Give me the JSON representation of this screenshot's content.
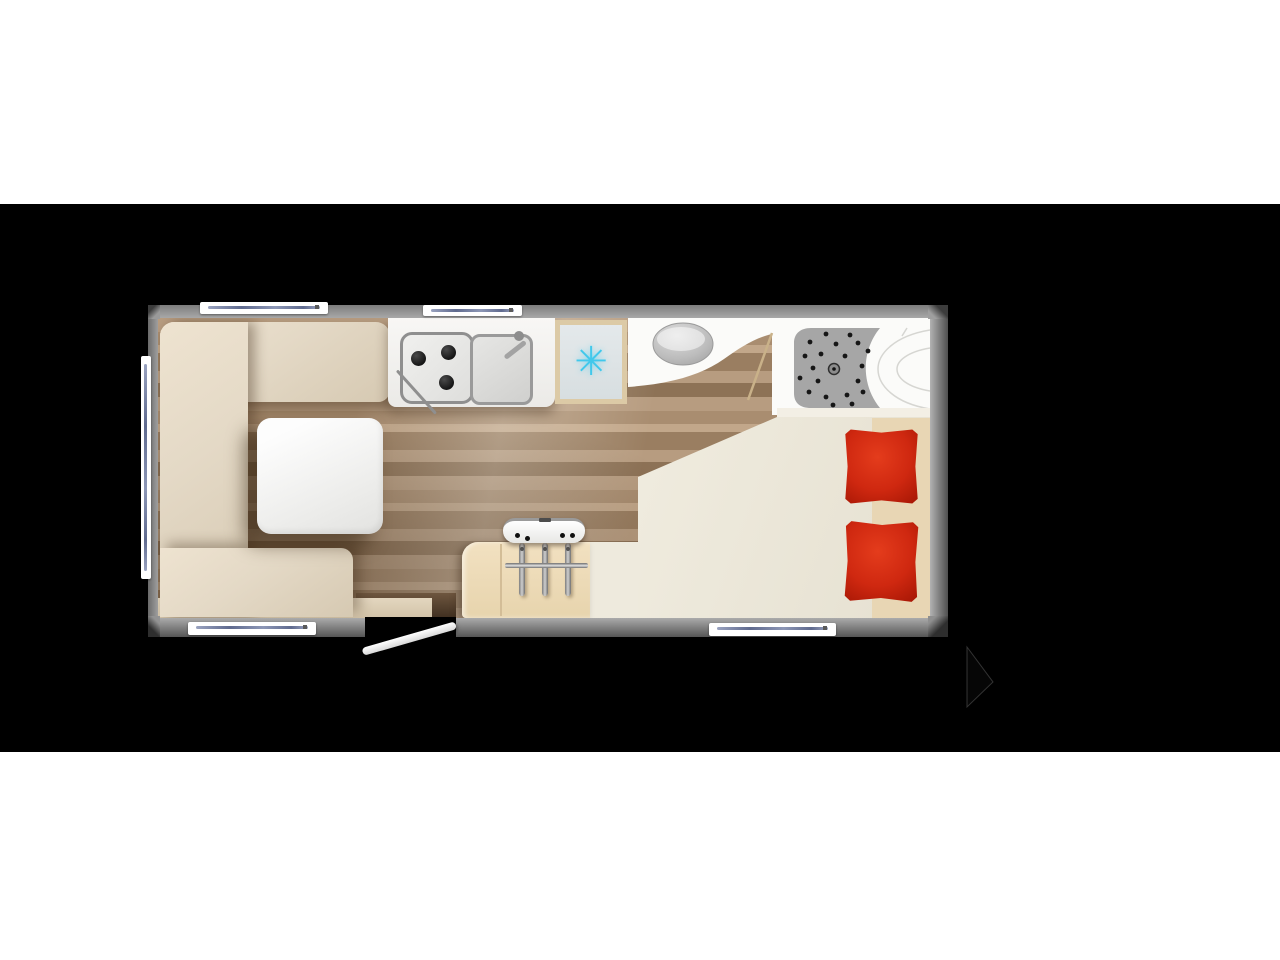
{
  "page": {
    "background": "#ffffff",
    "letterbox_color": "#000000",
    "content": "caravan-floorplan-top-view"
  },
  "colors": {
    "page_bg": "#ffffff",
    "letterbox": "#000000",
    "wall": "#9a9a9a",
    "wood_a": "#b79c80",
    "wood_b": "#a98d70",
    "wood_c": "#c2a78a",
    "wood_d": "#9a7e61",
    "wood_e": "#8d7256",
    "sofa": "#e4d9c6",
    "sofa_deep": "#d6c9b2",
    "counter": "#ebeae7",
    "burner": "#161616",
    "fridge_frame": "#dccaa6",
    "fridge_bg": "#e4e9eb",
    "snowflake": "#41c8eb",
    "bath_floor": "#fbfbf9",
    "shower_tray": "#a6a6a6",
    "tray_dot": "#161616",
    "toilet_gray": "#bcbcbc",
    "bed_base": "#ece8db",
    "bed_tan": "#e8d6b4",
    "pillow": "#cf2810",
    "pillow_dark": "#a01403",
    "wardrobe": "#e7d4ad",
    "window_line": "#5f6a8e",
    "door_recess": "#5d4734",
    "door_swing_line": "#c9b189"
  },
  "fixtures": {
    "fridge_freezer": {
      "icon": "snowflake-icon",
      "glyph": "✳"
    },
    "hob_burner_count": 3,
    "wardrobe_hanger_count": 3,
    "heater_vent_count": 4,
    "pillow_count": 2,
    "window_count": 5,
    "feature_names": [
      "u-shaped-lounge-sofa",
      "dining-table",
      "kitchen-counter",
      "three-burner-hob",
      "kitchen-sink",
      "fridge-freezer",
      "washroom-toilet",
      "shower-tray",
      "washbasin",
      "wardrobe-with-hangers",
      "heater-unit",
      "fixed-bed",
      "bed-pillows",
      "entry-door-open",
      "windows",
      "side-window"
    ]
  }
}
